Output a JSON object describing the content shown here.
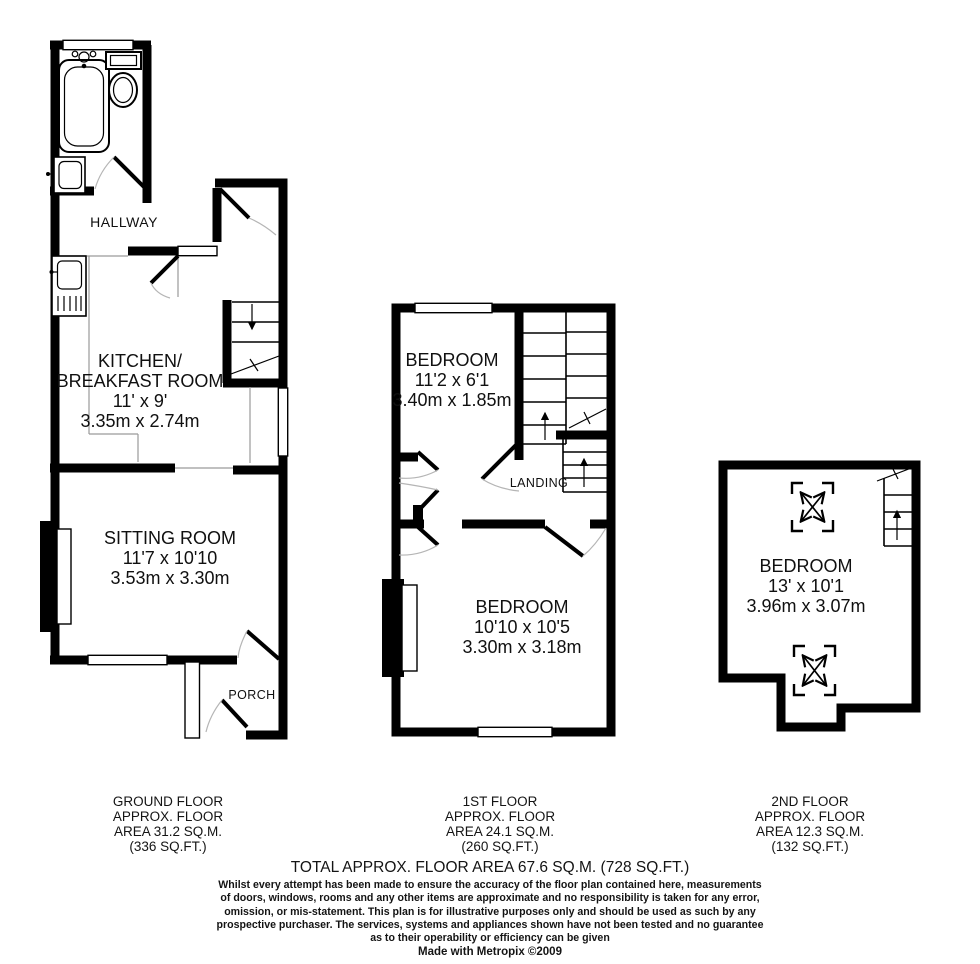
{
  "plans": {
    "ground": {
      "labels": {
        "hallway": "HALLWAY",
        "kitchen_line1": "KITCHEN/",
        "kitchen_line2": "BREAKFAST ROOM",
        "kitchen_dim_ft": "11' x 9'",
        "kitchen_dim_m": "3.35m x 2.74m",
        "sitting_name": "SITTING ROOM",
        "sitting_dim_ft": "11'7 x 10'10",
        "sitting_dim_m": "3.53m x 3.30m",
        "porch": "PORCH"
      },
      "caption": [
        "GROUND FLOOR",
        "APPROX. FLOOR",
        "AREA 31.2 SQ.M.",
        "(336 SQ.FT.)"
      ]
    },
    "first": {
      "labels": {
        "bedroom1_name": "BEDROOM",
        "bedroom1_dim_ft": "11'2 x 6'1",
        "bedroom1_dim_m": "3.40m x 1.85m",
        "landing": "LANDING",
        "bedroom2_name": "BEDROOM",
        "bedroom2_dim_ft": "10'10 x 10'5",
        "bedroom2_dim_m": "3.30m x 3.18m"
      },
      "caption": [
        "1ST FLOOR",
        "APPROX. FLOOR",
        "AREA 24.1 SQ.M.",
        "(260 SQ.FT.)"
      ]
    },
    "second": {
      "labels": {
        "bedroom_name": "BEDROOM",
        "bedroom_dim_ft": "13' x 10'1",
        "bedroom_dim_m": "3.96m x 3.07m"
      },
      "caption": [
        "2ND FLOOR",
        "APPROX. FLOOR",
        "AREA 12.3 SQ.M.",
        "(132 SQ.FT.)"
      ]
    }
  },
  "summary": {
    "total_area": "TOTAL APPROX. FLOOR AREA 67.6 SQ.M. (728 SQ.FT.)",
    "disclaimer": [
      "Whilst every attempt has been made to ensure the accuracy of the floor plan contained here, measurements",
      "of doors, windows, rooms and any other items are approximate and no responsibility is taken for any error,",
      "omission, or mis-statement. This plan is for illustrative purposes only and should be used as such by any",
      "prospective purchaser. The services, systems and appliances shown have not been tested and no guarantee",
      "as to their operability or efficiency can be given"
    ],
    "credit": "Made with Metropix ©2009"
  },
  "colors": {
    "wall": "#000000",
    "door_arc": "#b5b5b5",
    "guide_line": "#9a9a9a",
    "background": "#ffffff"
  }
}
